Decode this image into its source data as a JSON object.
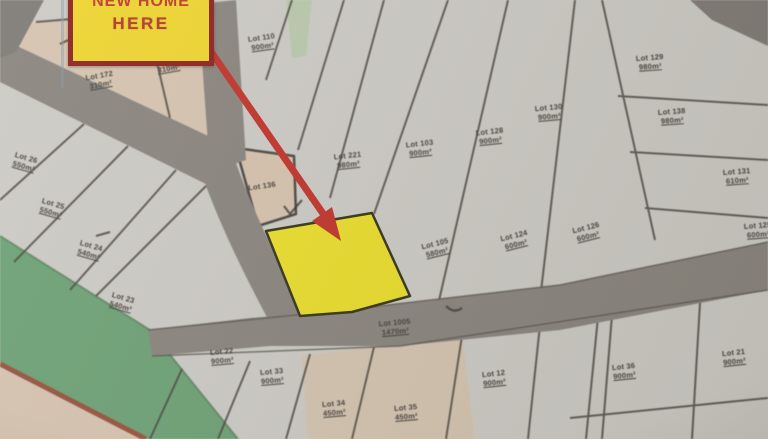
{
  "callout": {
    "line1": "NEW HOME",
    "line2": "HERE"
  },
  "map": {
    "highlighted_lot": "yellow highlighted parcel indicated by red arrow",
    "lots": [
      {
        "label": "Lot 172",
        "area": "310m²",
        "x": 100,
        "y": 80,
        "r": -10
      },
      {
        "label": "a",
        "area": "",
        "x": 112,
        "y": 62,
        "r": 0
      },
      {
        "label": "Lot 118",
        "area": "310m²",
        "x": 168,
        "y": 64,
        "r": -10
      },
      {
        "label": "Lot 110",
        "area": "900m²",
        "x": 262,
        "y": 42,
        "r": -8
      },
      {
        "label": "Lot 221",
        "area": "980m²",
        "x": 348,
        "y": 160,
        "r": -6
      },
      {
        "label": "Lot 103",
        "area": "900m²",
        "x": 420,
        "y": 148,
        "r": -6
      },
      {
        "label": "Lot 128",
        "area": "900m²",
        "x": 490,
        "y": 136,
        "r": -6
      },
      {
        "label": "Lot 130",
        "area": "900m²",
        "x": 549,
        "y": 112,
        "r": -5
      },
      {
        "label": "Lot 129",
        "area": "980m²",
        "x": 650,
        "y": 62,
        "r": -4
      },
      {
        "label": "Lot 138",
        "area": "980m²",
        "x": 672,
        "y": 116,
        "r": -4
      },
      {
        "label": "Lot 131",
        "area": "610m²",
        "x": 737,
        "y": 176,
        "r": -4
      },
      {
        "label": "Lot 125",
        "area": "600m²",
        "x": 758,
        "y": 230,
        "r": -4
      },
      {
        "label": "Lot 105",
        "area": "580m²",
        "x": 436,
        "y": 248,
        "r": -14
      },
      {
        "label": "Lot 124",
        "area": "600m²",
        "x": 515,
        "y": 240,
        "r": -14
      },
      {
        "label": "Lot 126",
        "area": "600m²",
        "x": 587,
        "y": 232,
        "r": -14
      },
      {
        "label": "Lot 136",
        "area": "",
        "x": 262,
        "y": 186,
        "r": -8
      },
      {
        "label": "Lot 1005",
        "area": "1470m²",
        "x": 395,
        "y": 327,
        "r": -5
      },
      {
        "label": "Lot 26",
        "area": "550m²",
        "x": 25,
        "y": 162,
        "r": 16
      },
      {
        "label": "Lot 25",
        "area": "550m²",
        "x": 52,
        "y": 208,
        "r": 16
      },
      {
        "label": "Lot 24",
        "area": "540m²",
        "x": 90,
        "y": 250,
        "r": 16
      },
      {
        "label": "Lot 23",
        "area": "540m²",
        "x": 122,
        "y": 302,
        "r": 16
      },
      {
        "label": "Lot 22",
        "area": "900m²",
        "x": 222,
        "y": 356,
        "r": -5
      },
      {
        "label": "Lot 33",
        "area": "900m²",
        "x": 272,
        "y": 376,
        "r": -5
      },
      {
        "label": "Lot 34",
        "area": "450m²",
        "x": 334,
        "y": 408,
        "r": -5
      },
      {
        "label": "Lot 35",
        "area": "450m²",
        "x": 406,
        "y": 412,
        "r": -5
      },
      {
        "label": "Lot 12",
        "area": "900m²",
        "x": 494,
        "y": 378,
        "r": -6
      },
      {
        "label": "Lot 36",
        "area": "900m²",
        "x": 624,
        "y": 371,
        "r": -6
      },
      {
        "label": "Lot 21",
        "area": "900m²",
        "x": 734,
        "y": 357,
        "r": -6
      }
    ]
  },
  "colors": {
    "paper": "#cfccc6",
    "tan": "#d9c4ab",
    "road": "#8a847c",
    "green": "#69a372",
    "green_pale": "#b5cba6",
    "highlight": "#e9dd2b",
    "arrow": "#c0332a",
    "callout_fill": "#eed42f",
    "callout_border": "#8e221d",
    "callout_text": "#bf3a2c",
    "line": "#4a463f",
    "label": "#403d38",
    "earth": "#9c4f38"
  }
}
